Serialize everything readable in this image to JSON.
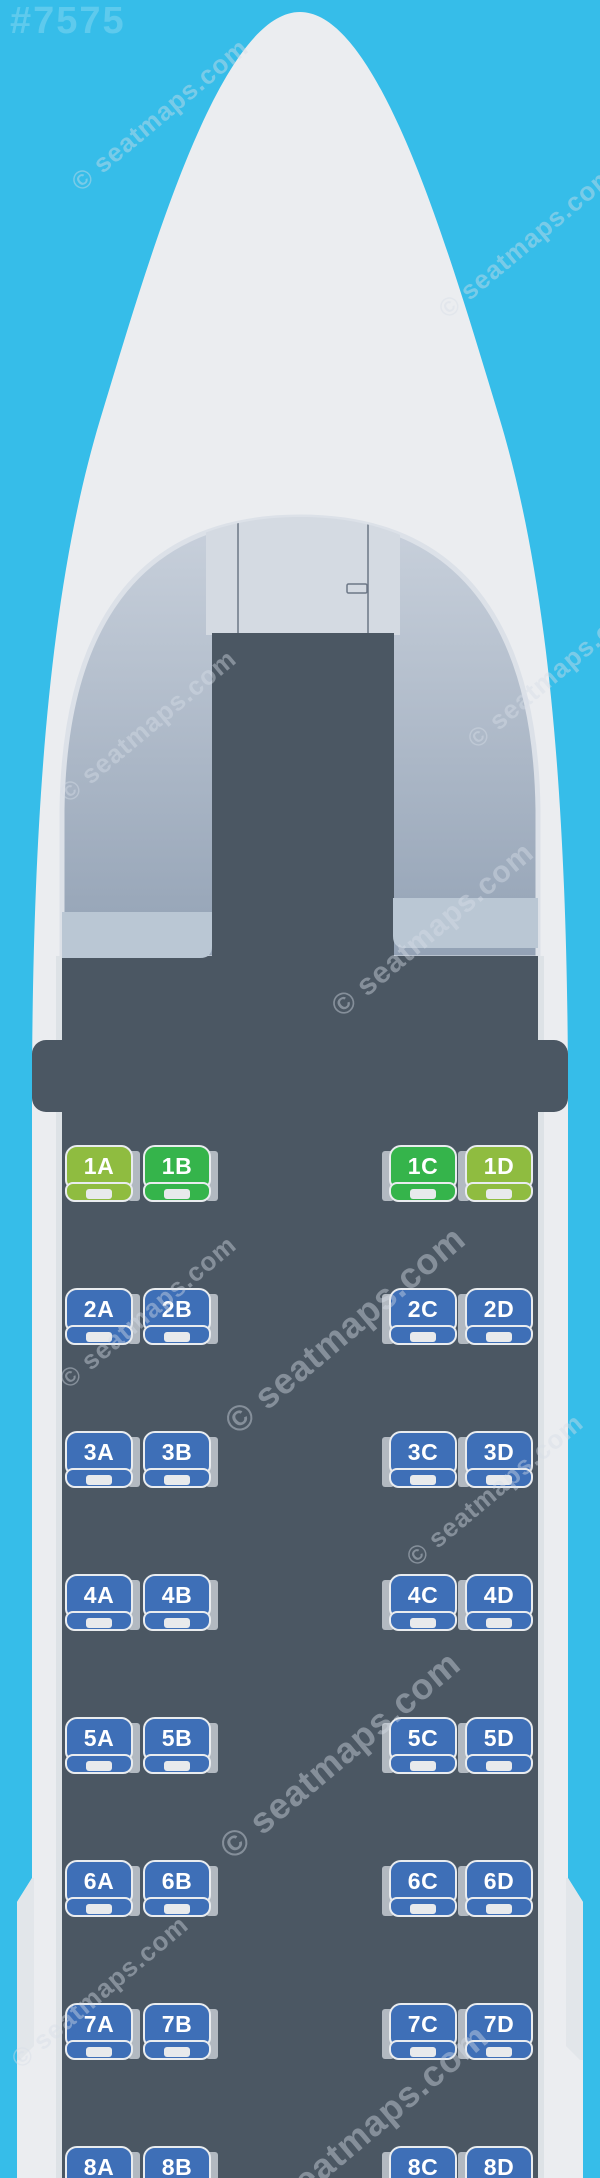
{
  "map_id": "#7575",
  "watermark_text": "© seatmaps.com",
  "colors": {
    "background": "#36bde9",
    "fuselage": "#ebedf0",
    "fuselage_shade": "#e2e6ea",
    "wall_edge": "#dde2e6",
    "cabin_dark": "#4b5763",
    "arch_top": "#c9d1dc",
    "arch_bottom": "#93a2b5",
    "cockpit_panel": "#d4dae2",
    "cockpit_line": "#6c7786",
    "monument": "#bac7d4",
    "seat_border": "#e9ecef",
    "seat_back_tab": "#b2b9c1",
    "seat_notch": "#e8eaec",
    "seat_blue": "#3e6fb7",
    "seat_green": "#35b44b",
    "seat_lime": "#8fbc40"
  },
  "cabin": {
    "columns": [
      "A",
      "B",
      "C",
      "D"
    ],
    "aisle_after_column": "B",
    "rows": [
      {
        "number": 1,
        "seats": [
          {
            "id": "1A",
            "type": "lime"
          },
          {
            "id": "1B",
            "type": "green"
          },
          {
            "id": "1C",
            "type": "green"
          },
          {
            "id": "1D",
            "type": "lime"
          }
        ]
      },
      {
        "number": 2,
        "seats": [
          {
            "id": "2A",
            "type": "blue"
          },
          {
            "id": "2B",
            "type": "blue"
          },
          {
            "id": "2C",
            "type": "blue"
          },
          {
            "id": "2D",
            "type": "blue"
          }
        ]
      },
      {
        "number": 3,
        "seats": [
          {
            "id": "3A",
            "type": "blue"
          },
          {
            "id": "3B",
            "type": "blue"
          },
          {
            "id": "3C",
            "type": "blue"
          },
          {
            "id": "3D",
            "type": "blue"
          }
        ]
      },
      {
        "number": 4,
        "seats": [
          {
            "id": "4A",
            "type": "blue"
          },
          {
            "id": "4B",
            "type": "blue"
          },
          {
            "id": "4C",
            "type": "blue"
          },
          {
            "id": "4D",
            "type": "blue"
          }
        ]
      },
      {
        "number": 5,
        "seats": [
          {
            "id": "5A",
            "type": "blue"
          },
          {
            "id": "5B",
            "type": "blue"
          },
          {
            "id": "5C",
            "type": "blue"
          },
          {
            "id": "5D",
            "type": "blue"
          }
        ]
      },
      {
        "number": 6,
        "seats": [
          {
            "id": "6A",
            "type": "blue"
          },
          {
            "id": "6B",
            "type": "blue"
          },
          {
            "id": "6C",
            "type": "blue"
          },
          {
            "id": "6D",
            "type": "blue"
          }
        ]
      },
      {
        "number": 7,
        "seats": [
          {
            "id": "7A",
            "type": "blue"
          },
          {
            "id": "7B",
            "type": "blue"
          },
          {
            "id": "7C",
            "type": "blue"
          },
          {
            "id": "7D",
            "type": "blue"
          }
        ]
      },
      {
        "number": 8,
        "seats": [
          {
            "id": "8A",
            "type": "blue"
          },
          {
            "id": "8B",
            "type": "blue"
          },
          {
            "id": "8C",
            "type": "blue"
          },
          {
            "id": "8D",
            "type": "blue"
          }
        ]
      }
    ]
  }
}
